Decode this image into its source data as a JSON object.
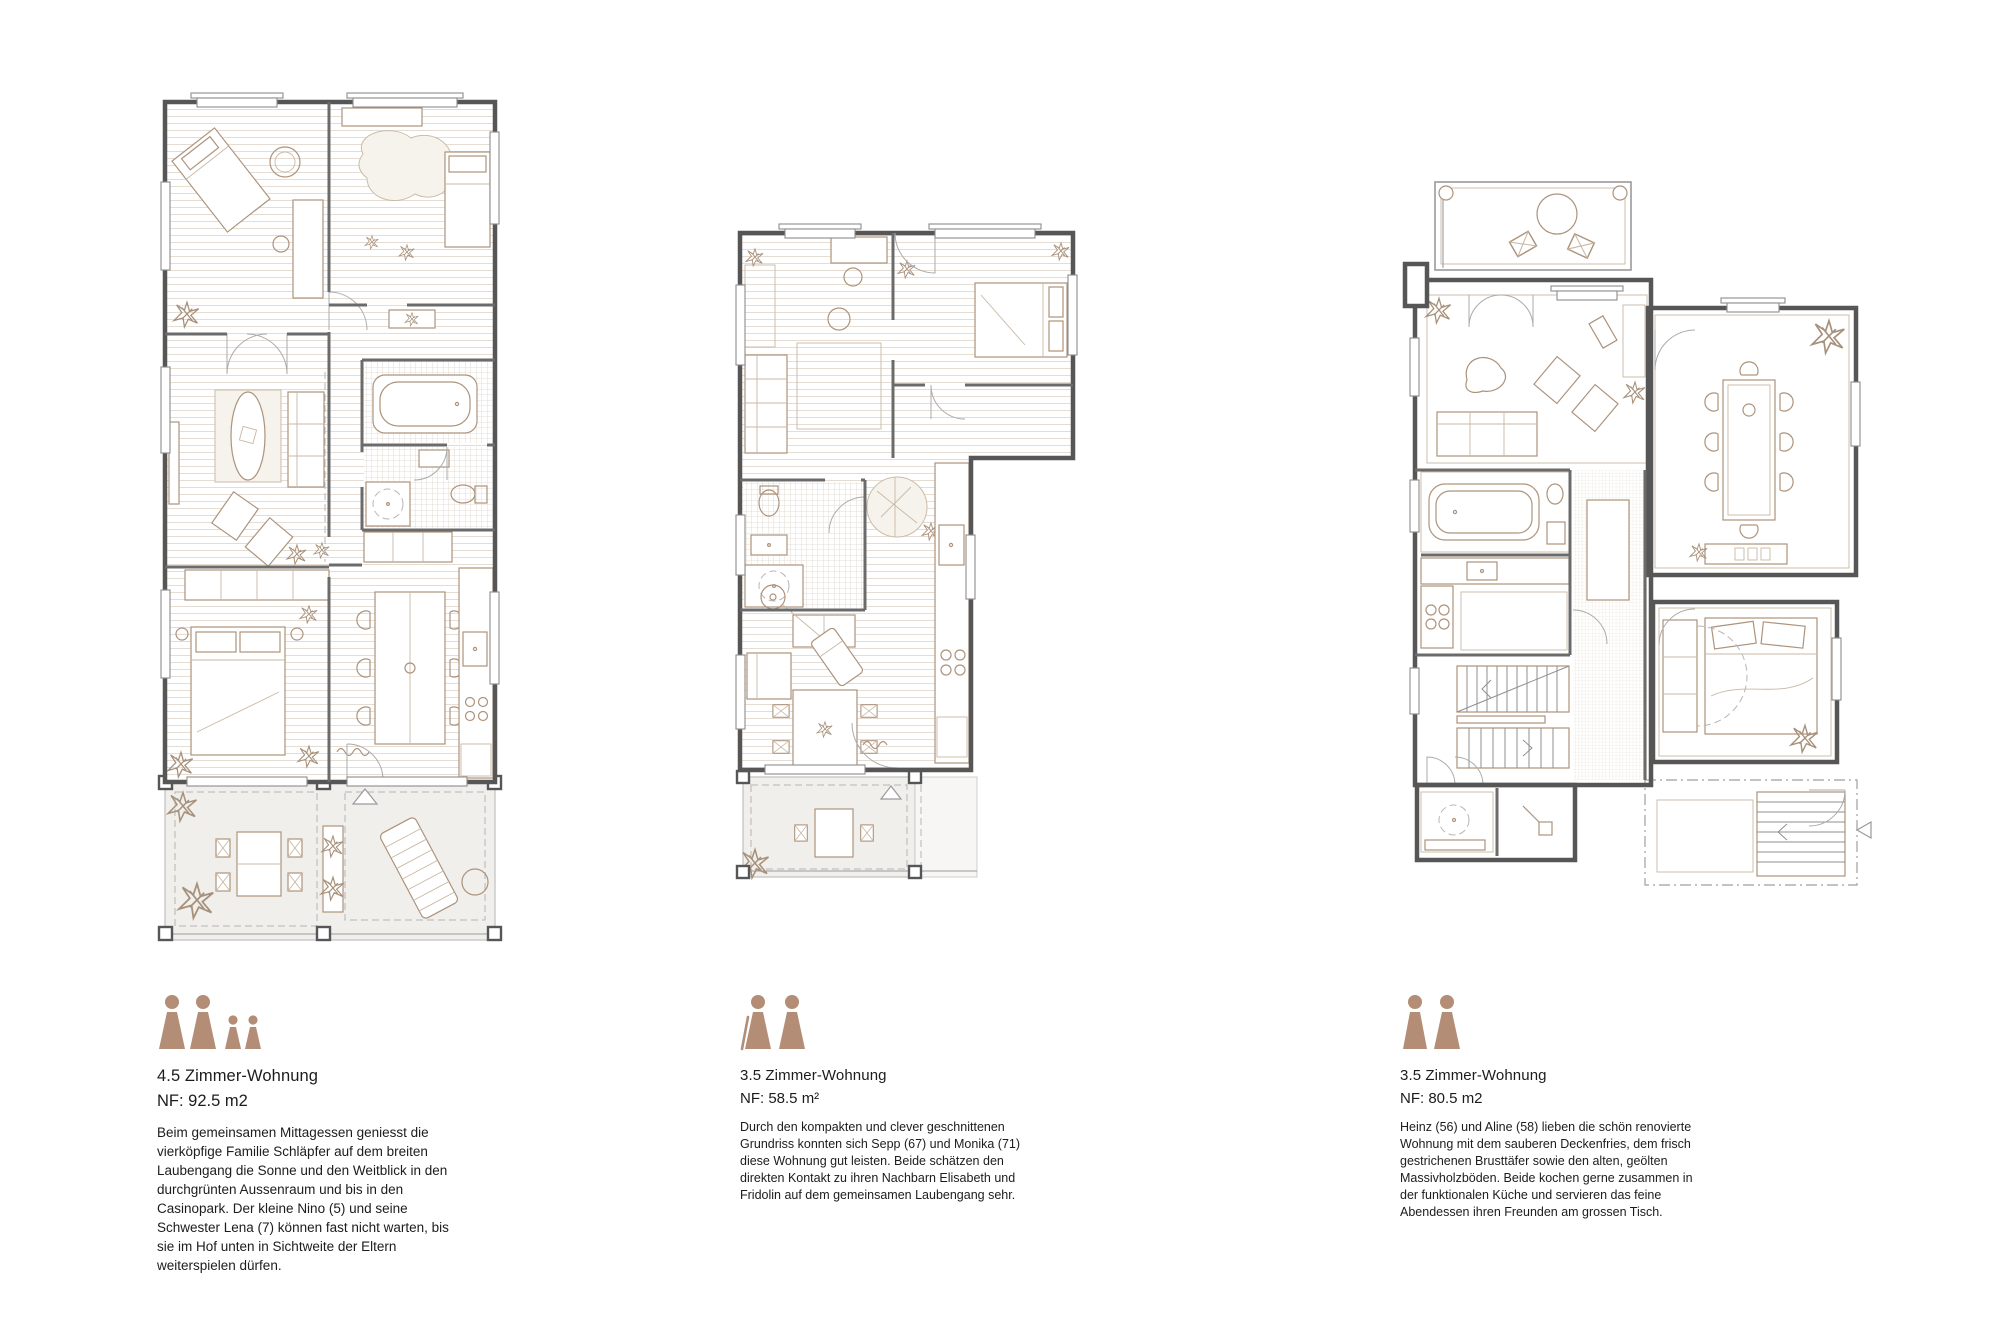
{
  "page": {
    "background": "#ffffff"
  },
  "colors": {
    "accent_person": "#b38d76",
    "wall": "#565656",
    "furniture_line": "#ad937c",
    "hatch": "#ddd3c7"
  },
  "units": [
    {
      "title": "4.5 Zimmer-Wohnung",
      "area": "NF: 92.5 m2",
      "occupants": [
        "adult",
        "adult",
        "child",
        "child"
      ],
      "description": "Beim gemeinsamen Mittagessen geniesst die vierköpfige Familie Schläpfer auf dem breiten Laubengang die Sonne und den Weitblick in den durchgrünten Aussenraum und bis in den Casinopark. Der kleine Nino (5) und seine Schwester Lena (7) können fast nicht warten, bis sie im Hof unten in Sichtweite der Eltern weiterspielen dürfen."
    },
    {
      "title": "3.5 Zimmer-Wohnung",
      "area": "NF: 58.5 m²",
      "occupants": [
        "elderly-adult",
        "adult"
      ],
      "description": "Durch den kompakten und clever geschnittenen Grundriss konnten sich Sepp (67) und Monika (71) diese Wohnung gut leisten. Beide schätzen den direkten Kontakt zu ihren Nachbarn Elisabeth und Fridolin auf dem gemeinsamen Laubengang sehr."
    },
    {
      "title": "3.5 Zimmer-Wohnung",
      "area": "NF: 80.5 m2",
      "occupants": [
        "adult",
        "adult"
      ],
      "description": "Heinz (56) und Aline (58) lieben die schön renovierte Wohnung mit dem sauberen Deckenfries, dem frisch gestrichenen Brusttäfer sowie den alten, geölten Massivholzböden. Beide kochen gerne zusammen in der funktionalen Küche und servieren das feine Abendessen ihren Freunden am grossen Tisch."
    }
  ]
}
